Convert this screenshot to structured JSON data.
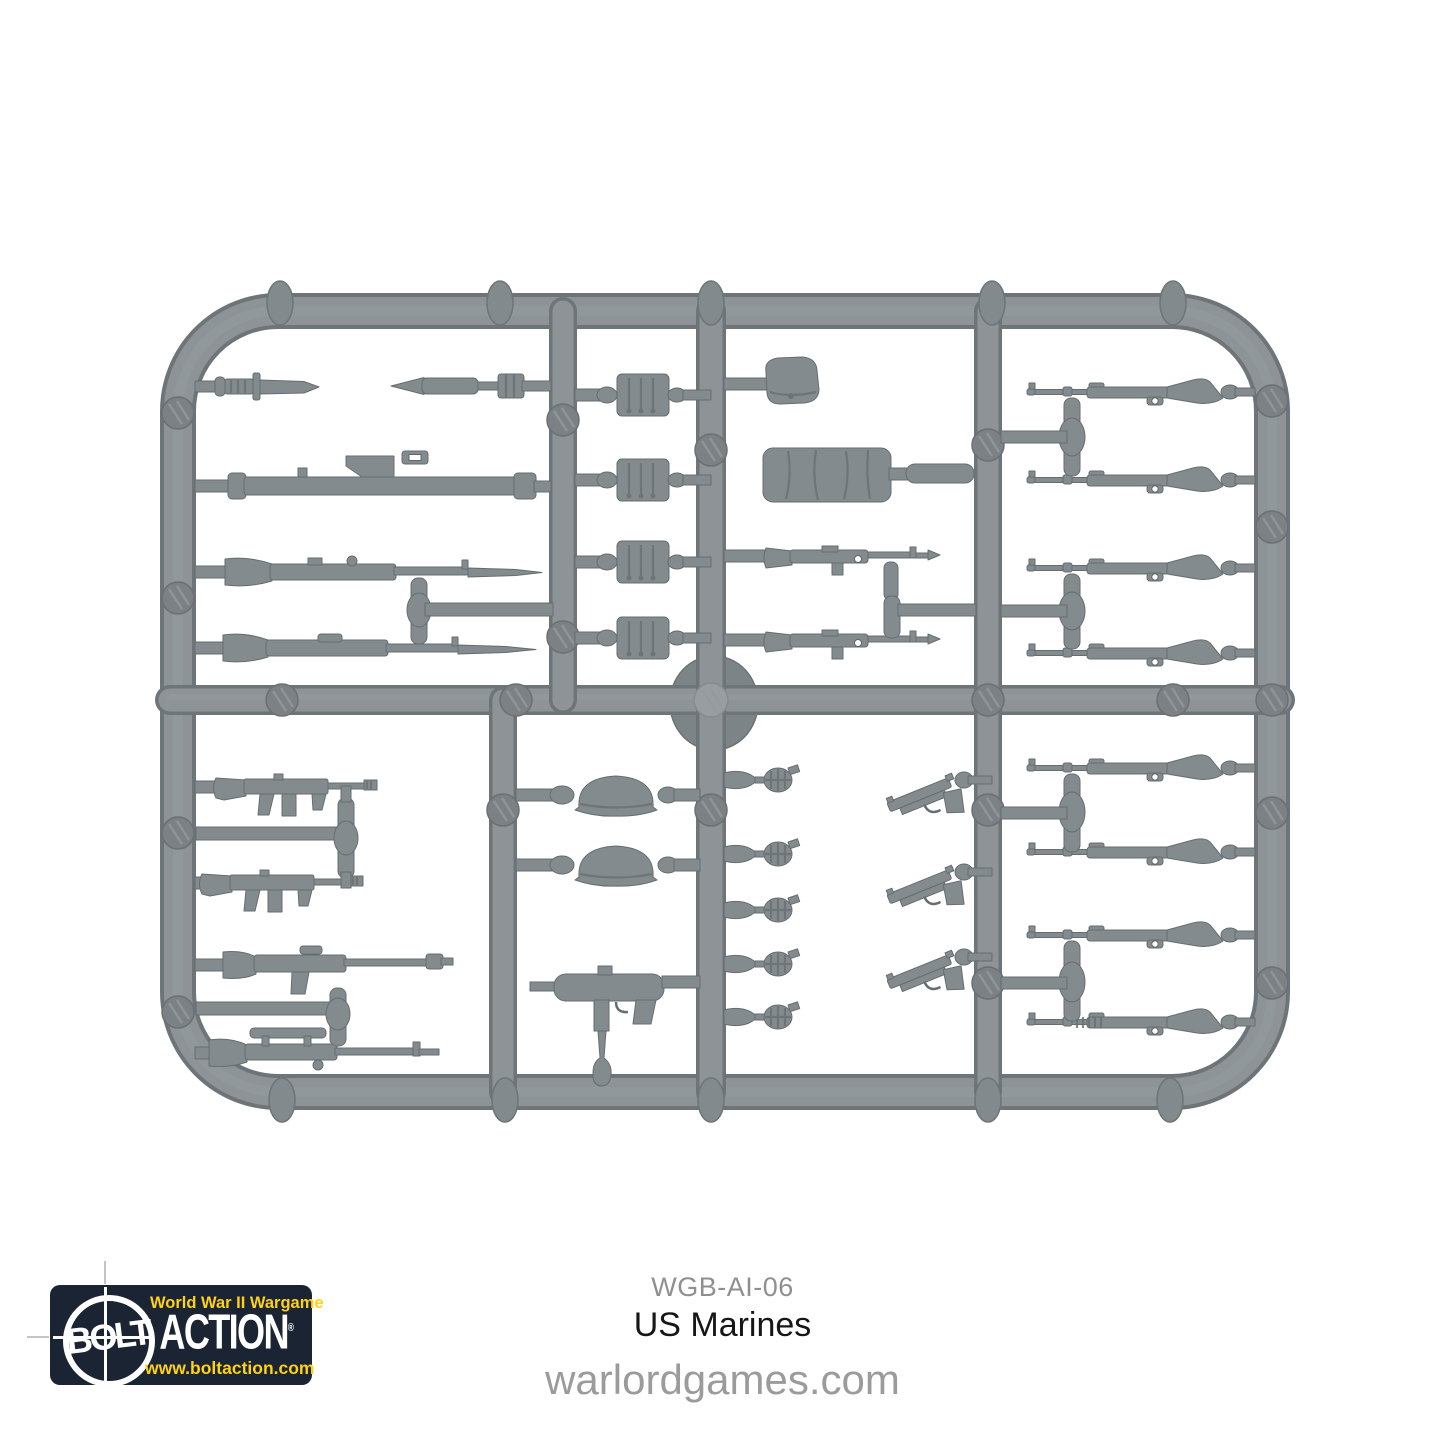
{
  "page": {
    "background_color": "#ffffff"
  },
  "caption": {
    "sku": "WGB-AI-06",
    "product_name": "US Marines",
    "website": "warlordgames.com"
  },
  "logo": {
    "tagline": "World War II Wargame",
    "brand_circle_word": "BOLT",
    "brand_word": "ACTION",
    "registered_mark": "®",
    "url": "www.boltaction.com",
    "background_color": "#1b2433",
    "accent_color": "#ffd117"
  },
  "sprue": {
    "plastic_color": "#8d9396",
    "parts": [
      "bayonet",
      "bazooka-rocket",
      "bazooka",
      "rifle-with-bayonet",
      "rifle-with-bayonet",
      "ammo-bandolier",
      "ammo-bandolier",
      "ammo-bandolier",
      "ammo-bandolier",
      "utility-cap",
      "bedroll",
      "m1-carbine",
      "m1-carbine",
      "m1-garand-rifle",
      "m1-garand-rifle",
      "m1-garand-rifle",
      "m1-garand-rifle",
      "thompson-smg",
      "thompson-smg",
      "bar-rifle",
      "scoped-rifle",
      "m1-helmet",
      "m1-helmet",
      "m3-grease-gun",
      "grenade",
      "grenade",
      "grenade",
      "grenade",
      "grenade",
      "m1911-pistol",
      "m1911-pistol",
      "m1911-pistol",
      "m1-garand-rifle",
      "m1-garand-rifle",
      "m1-garand-rifle",
      "ribbed-barrel-rifle"
    ]
  }
}
